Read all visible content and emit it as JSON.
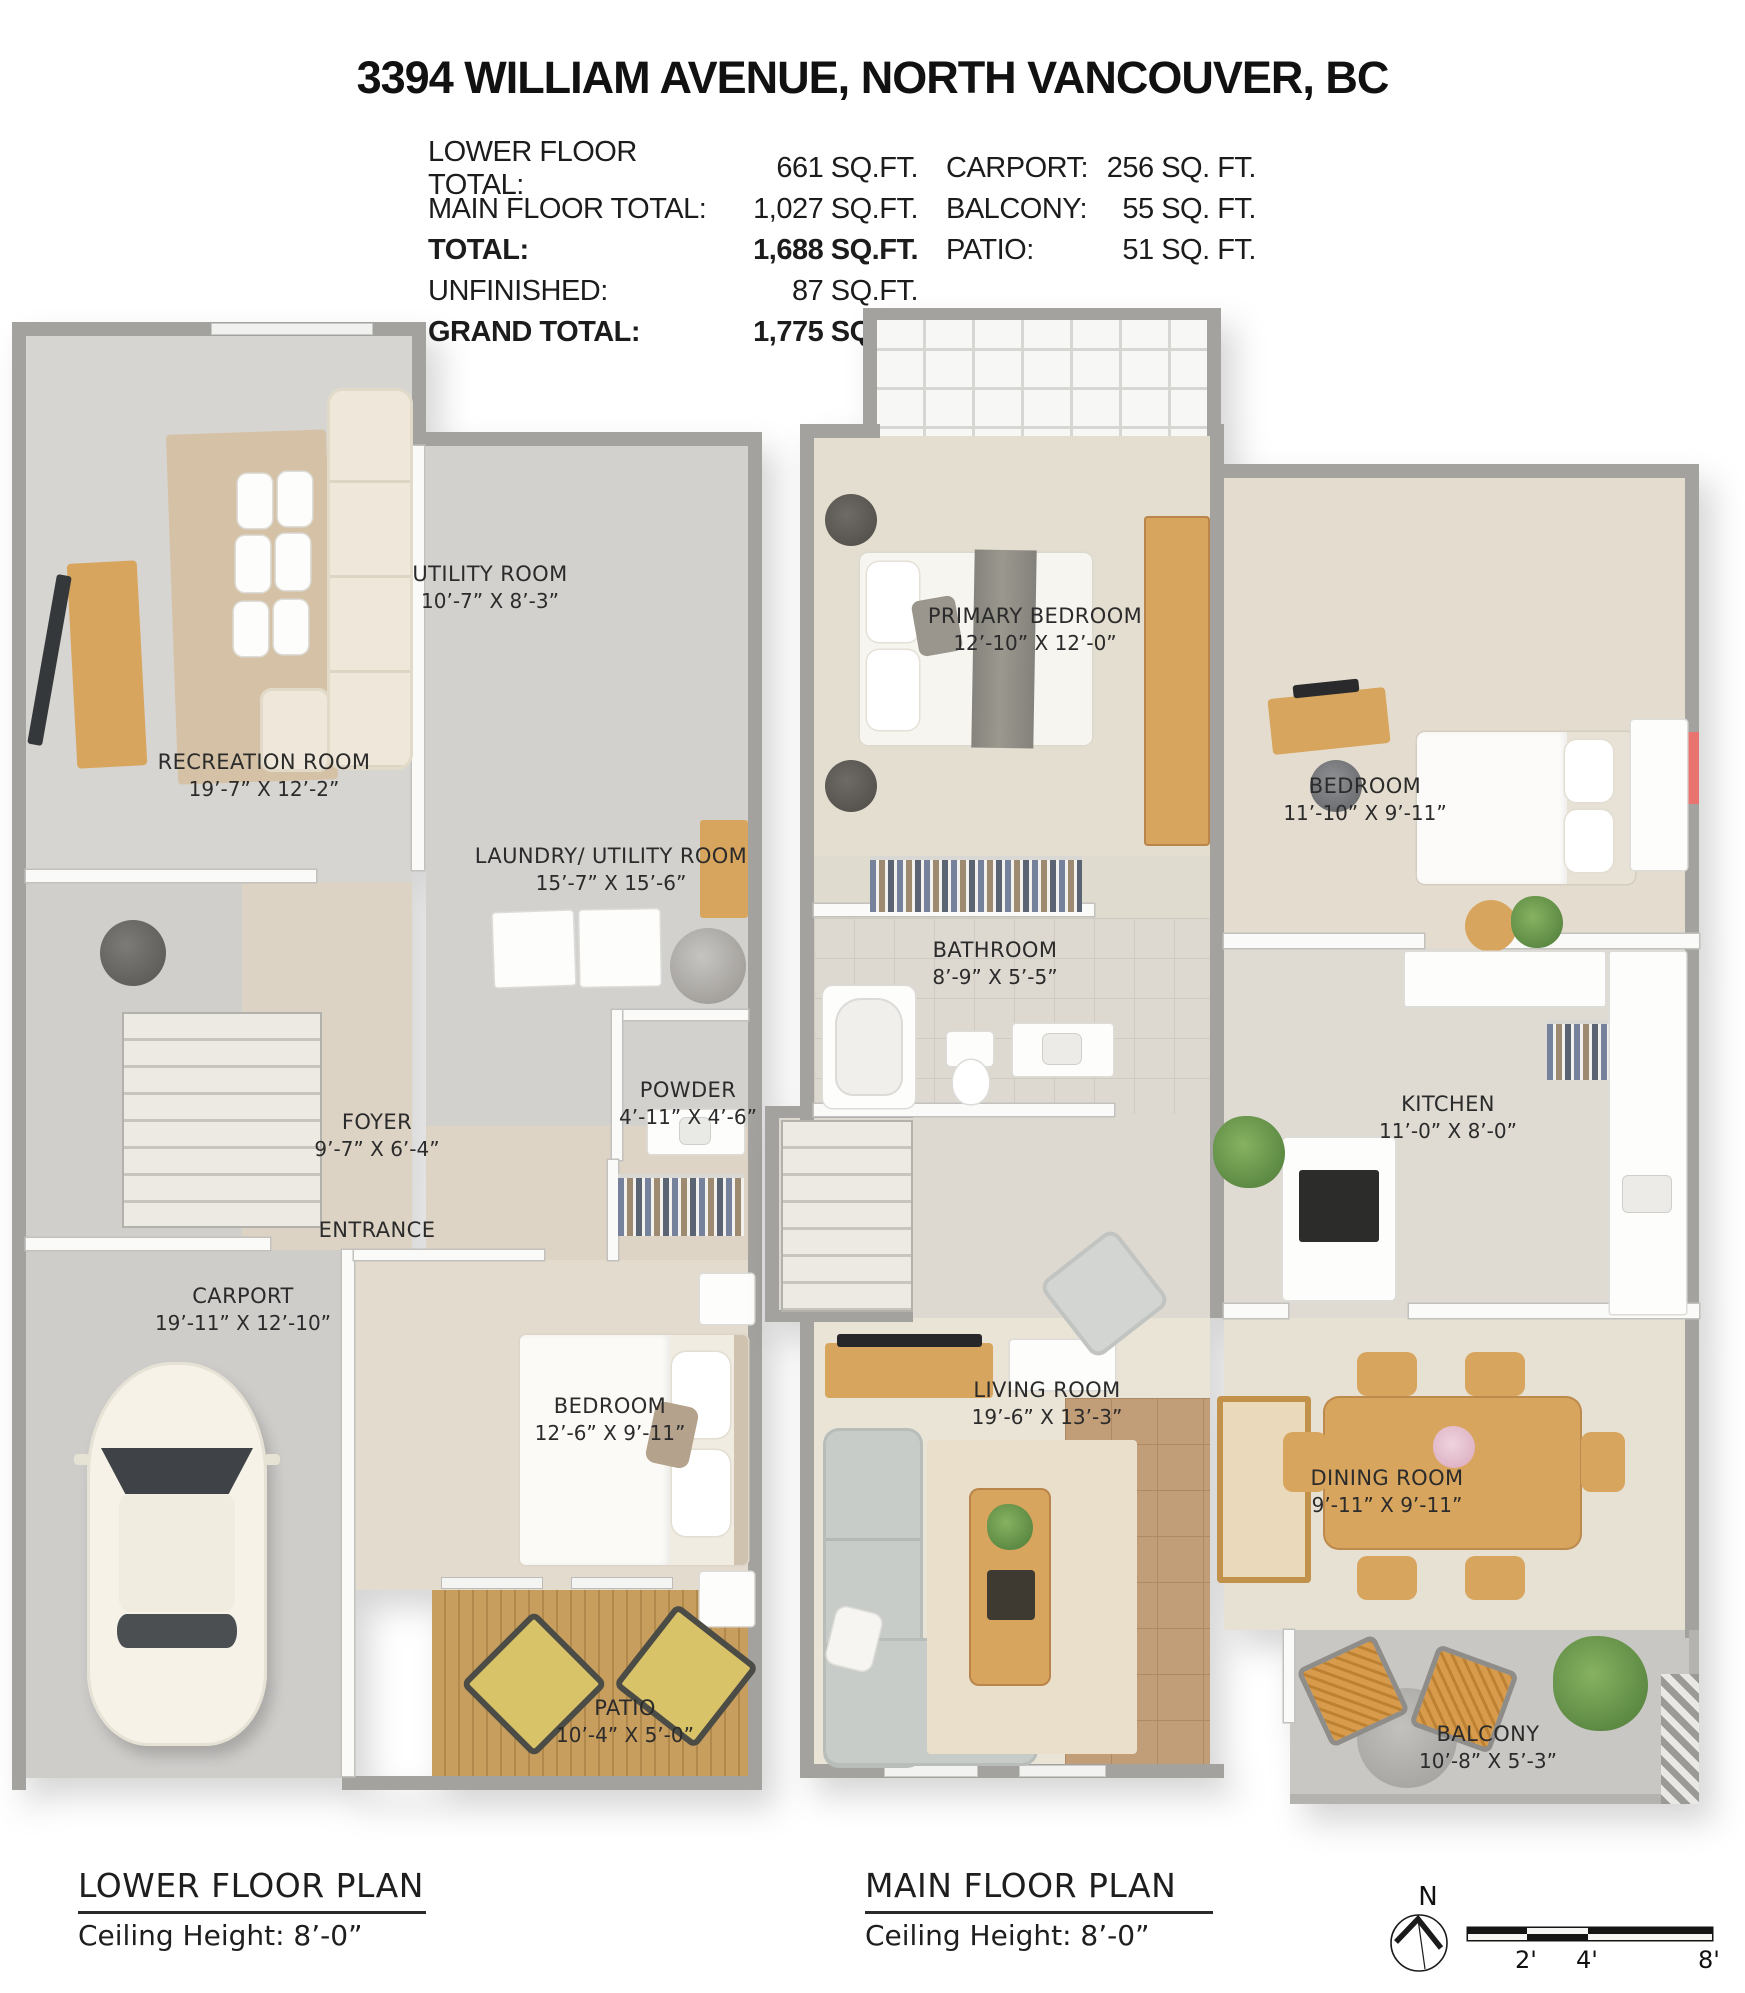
{
  "header": {
    "title": "3394 WILLIAM AVENUE, NORTH VANCOUVER, BC",
    "stats": {
      "rows": [
        {
          "l_label": "LOWER FLOOR TOTAL:",
          "l_value": "661 SQ.FT.",
          "r_label": "CARPORT:",
          "r_value": "256 SQ. FT."
        },
        {
          "l_label": "MAIN FLOOR TOTAL:",
          "l_value": "1,027 SQ.FT.",
          "r_label": "BALCONY:",
          "r_value": "55 SQ. FT."
        },
        {
          "l_label": "TOTAL:",
          "l_value": "1,688 SQ.FT.",
          "r_label": "PATIO:",
          "r_value": "51 SQ. FT."
        },
        {
          "l_label": "UNFINISHED:",
          "l_value": "87 SQ.FT.",
          "r_label": "",
          "r_value": ""
        },
        {
          "l_label": "GRAND TOTAL:",
          "l_value": "1,775 SQ.FT.",
          "r_label": "",
          "r_value": ""
        }
      ]
    }
  },
  "lower_floor": {
    "caption": "LOWER FLOOR PLAN",
    "ceiling_height": "Ceiling Height: 8’-0”",
    "rooms": {
      "recreation": {
        "name": "RECREATION ROOM",
        "dims": "19’-7” X 12’-2”"
      },
      "utility": {
        "name": "UTILITY ROOM",
        "dims": "10’-7” X 8’-3”"
      },
      "laundry": {
        "name": "LAUNDRY/ UTILITY ROOM",
        "dims": "15’-7” X 15’-6”"
      },
      "powder": {
        "name": "POWDER",
        "dims": "4’-11” X 4’-6”"
      },
      "foyer": {
        "name": "FOYER",
        "dims": "9’-7” X 6’-4”"
      },
      "entrance": {
        "name": "ENTRANCE"
      },
      "carport": {
        "name": "CARPORT",
        "dims": "19’-11” X 12’-10”"
      },
      "bedroom": {
        "name": "BEDROOM",
        "dims": "12’-6” X 9’-11”"
      },
      "patio": {
        "name": "PATIO",
        "dims": "10’-4” X 5’-0”"
      }
    }
  },
  "main_floor": {
    "caption": "MAIN FLOOR PLAN",
    "ceiling_height": "Ceiling Height: 8’-0”",
    "rooms": {
      "primary_bedroom": {
        "name": "PRIMARY BEDROOM",
        "dims": "12’-10” X 12’-0”"
      },
      "bedroom": {
        "name": "BEDROOM",
        "dims": "11’-10” X 9’-11”"
      },
      "bathroom": {
        "name": "BATHROOM",
        "dims": "8’-9” X 5’-5”"
      },
      "kitchen": {
        "name": "KITCHEN",
        "dims": "11’-0” X 8’-0”"
      },
      "living_room": {
        "name": "LIVING ROOM",
        "dims": "19’-6” X 13’-3”"
      },
      "dining_room": {
        "name": "DINING ROOM",
        "dims": "9’-11” X 9’-11”"
      },
      "balcony": {
        "name": "BALCONY",
        "dims": "10’-8” X 5’-3”"
      }
    }
  },
  "legend": {
    "north_label": "N",
    "scale_labels": [
      "2'",
      "4'",
      "8'"
    ]
  }
}
